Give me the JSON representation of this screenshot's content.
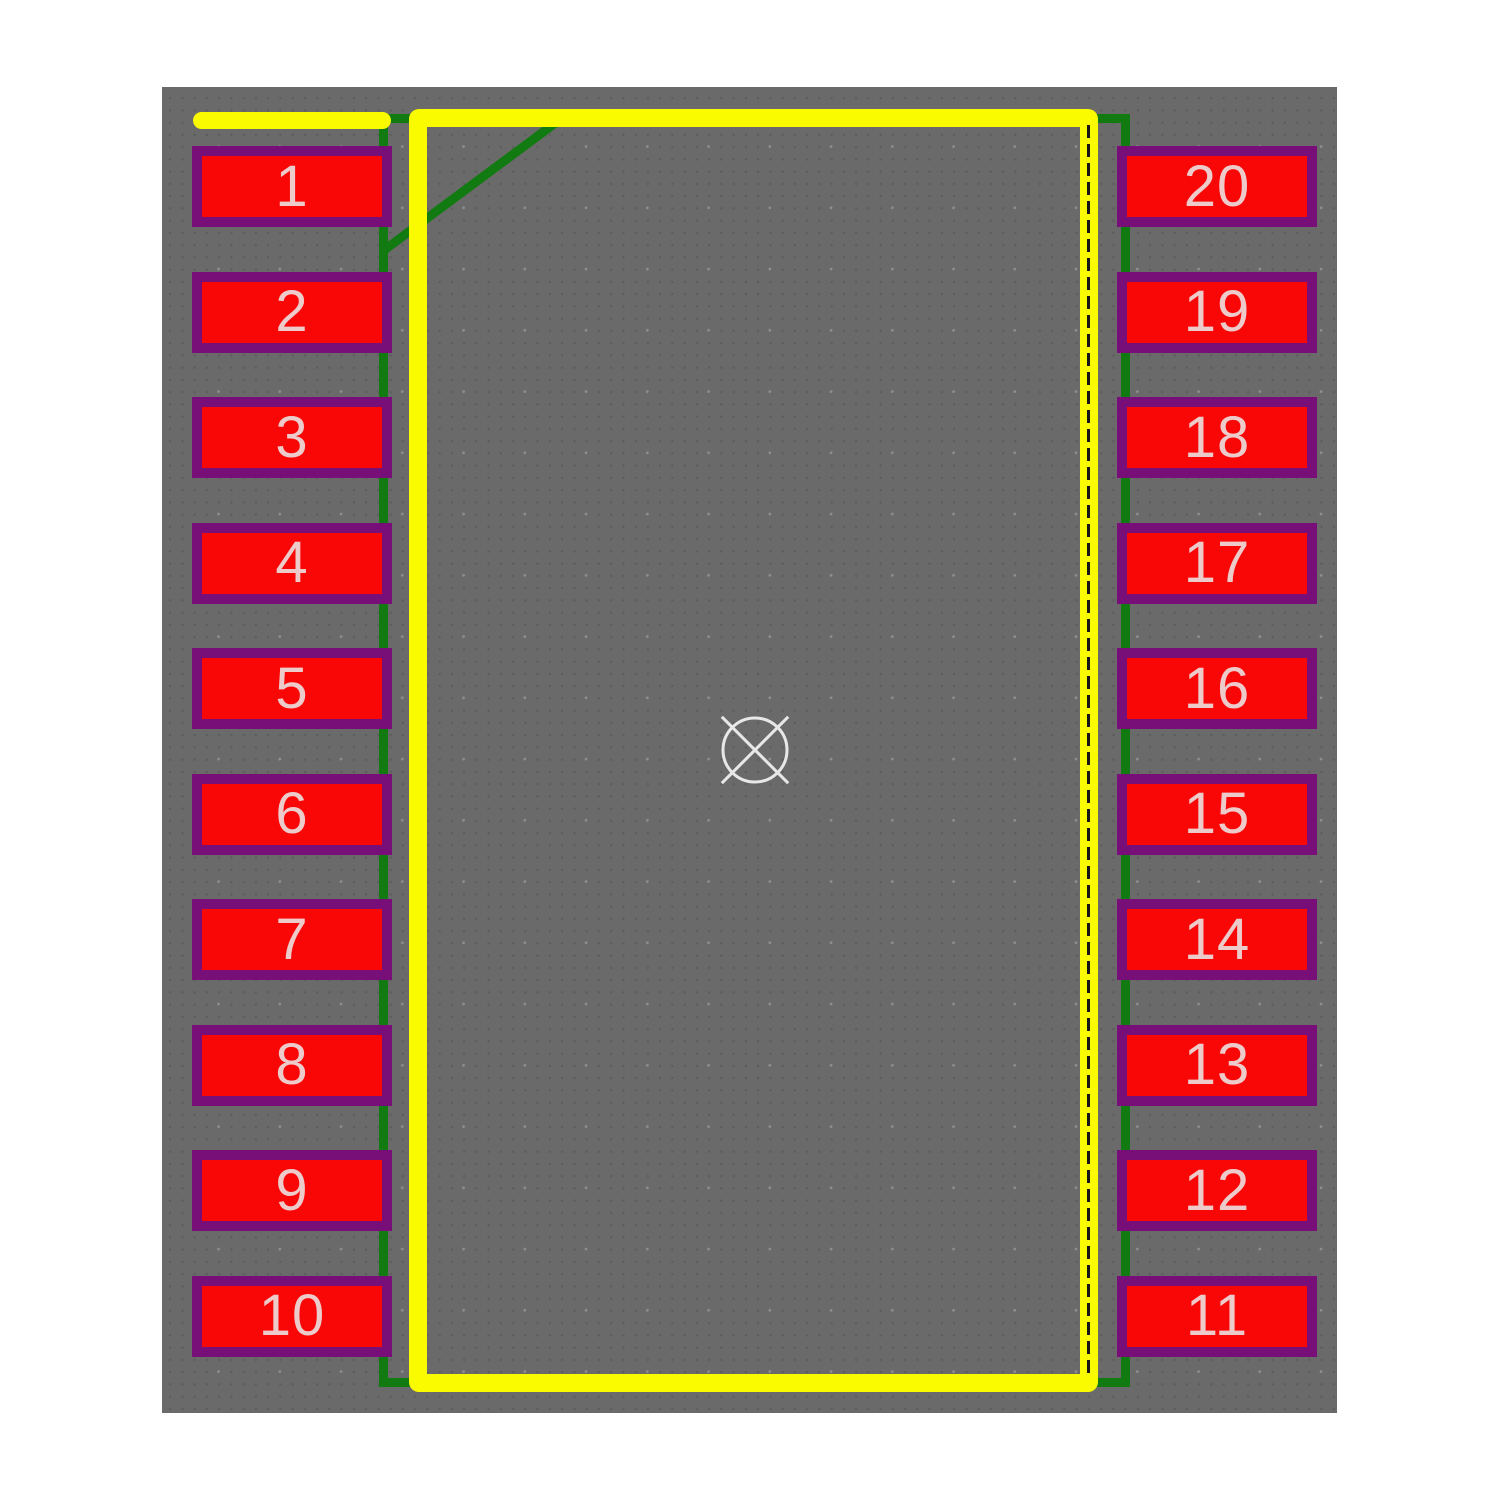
{
  "viewer": {
    "description": "PCB footprint preview, 20-pad dual-row package",
    "background_color": "#6a6a6a",
    "silkscreen_color": "#fbfb00",
    "courtyard_color": "#117a11",
    "pad_fill_color": "#f90606",
    "pad_outline_color": "#780e78",
    "pad_number_color": "#edcbcb",
    "assembly_line_color": "#161616",
    "origin_marker_color": "#e8e8e8"
  },
  "pads": {
    "left": [
      "1",
      "2",
      "3",
      "4",
      "5",
      "6",
      "7",
      "8",
      "9",
      "10"
    ],
    "right": [
      "20",
      "19",
      "18",
      "17",
      "16",
      "15",
      "14",
      "13",
      "12",
      "11"
    ]
  }
}
